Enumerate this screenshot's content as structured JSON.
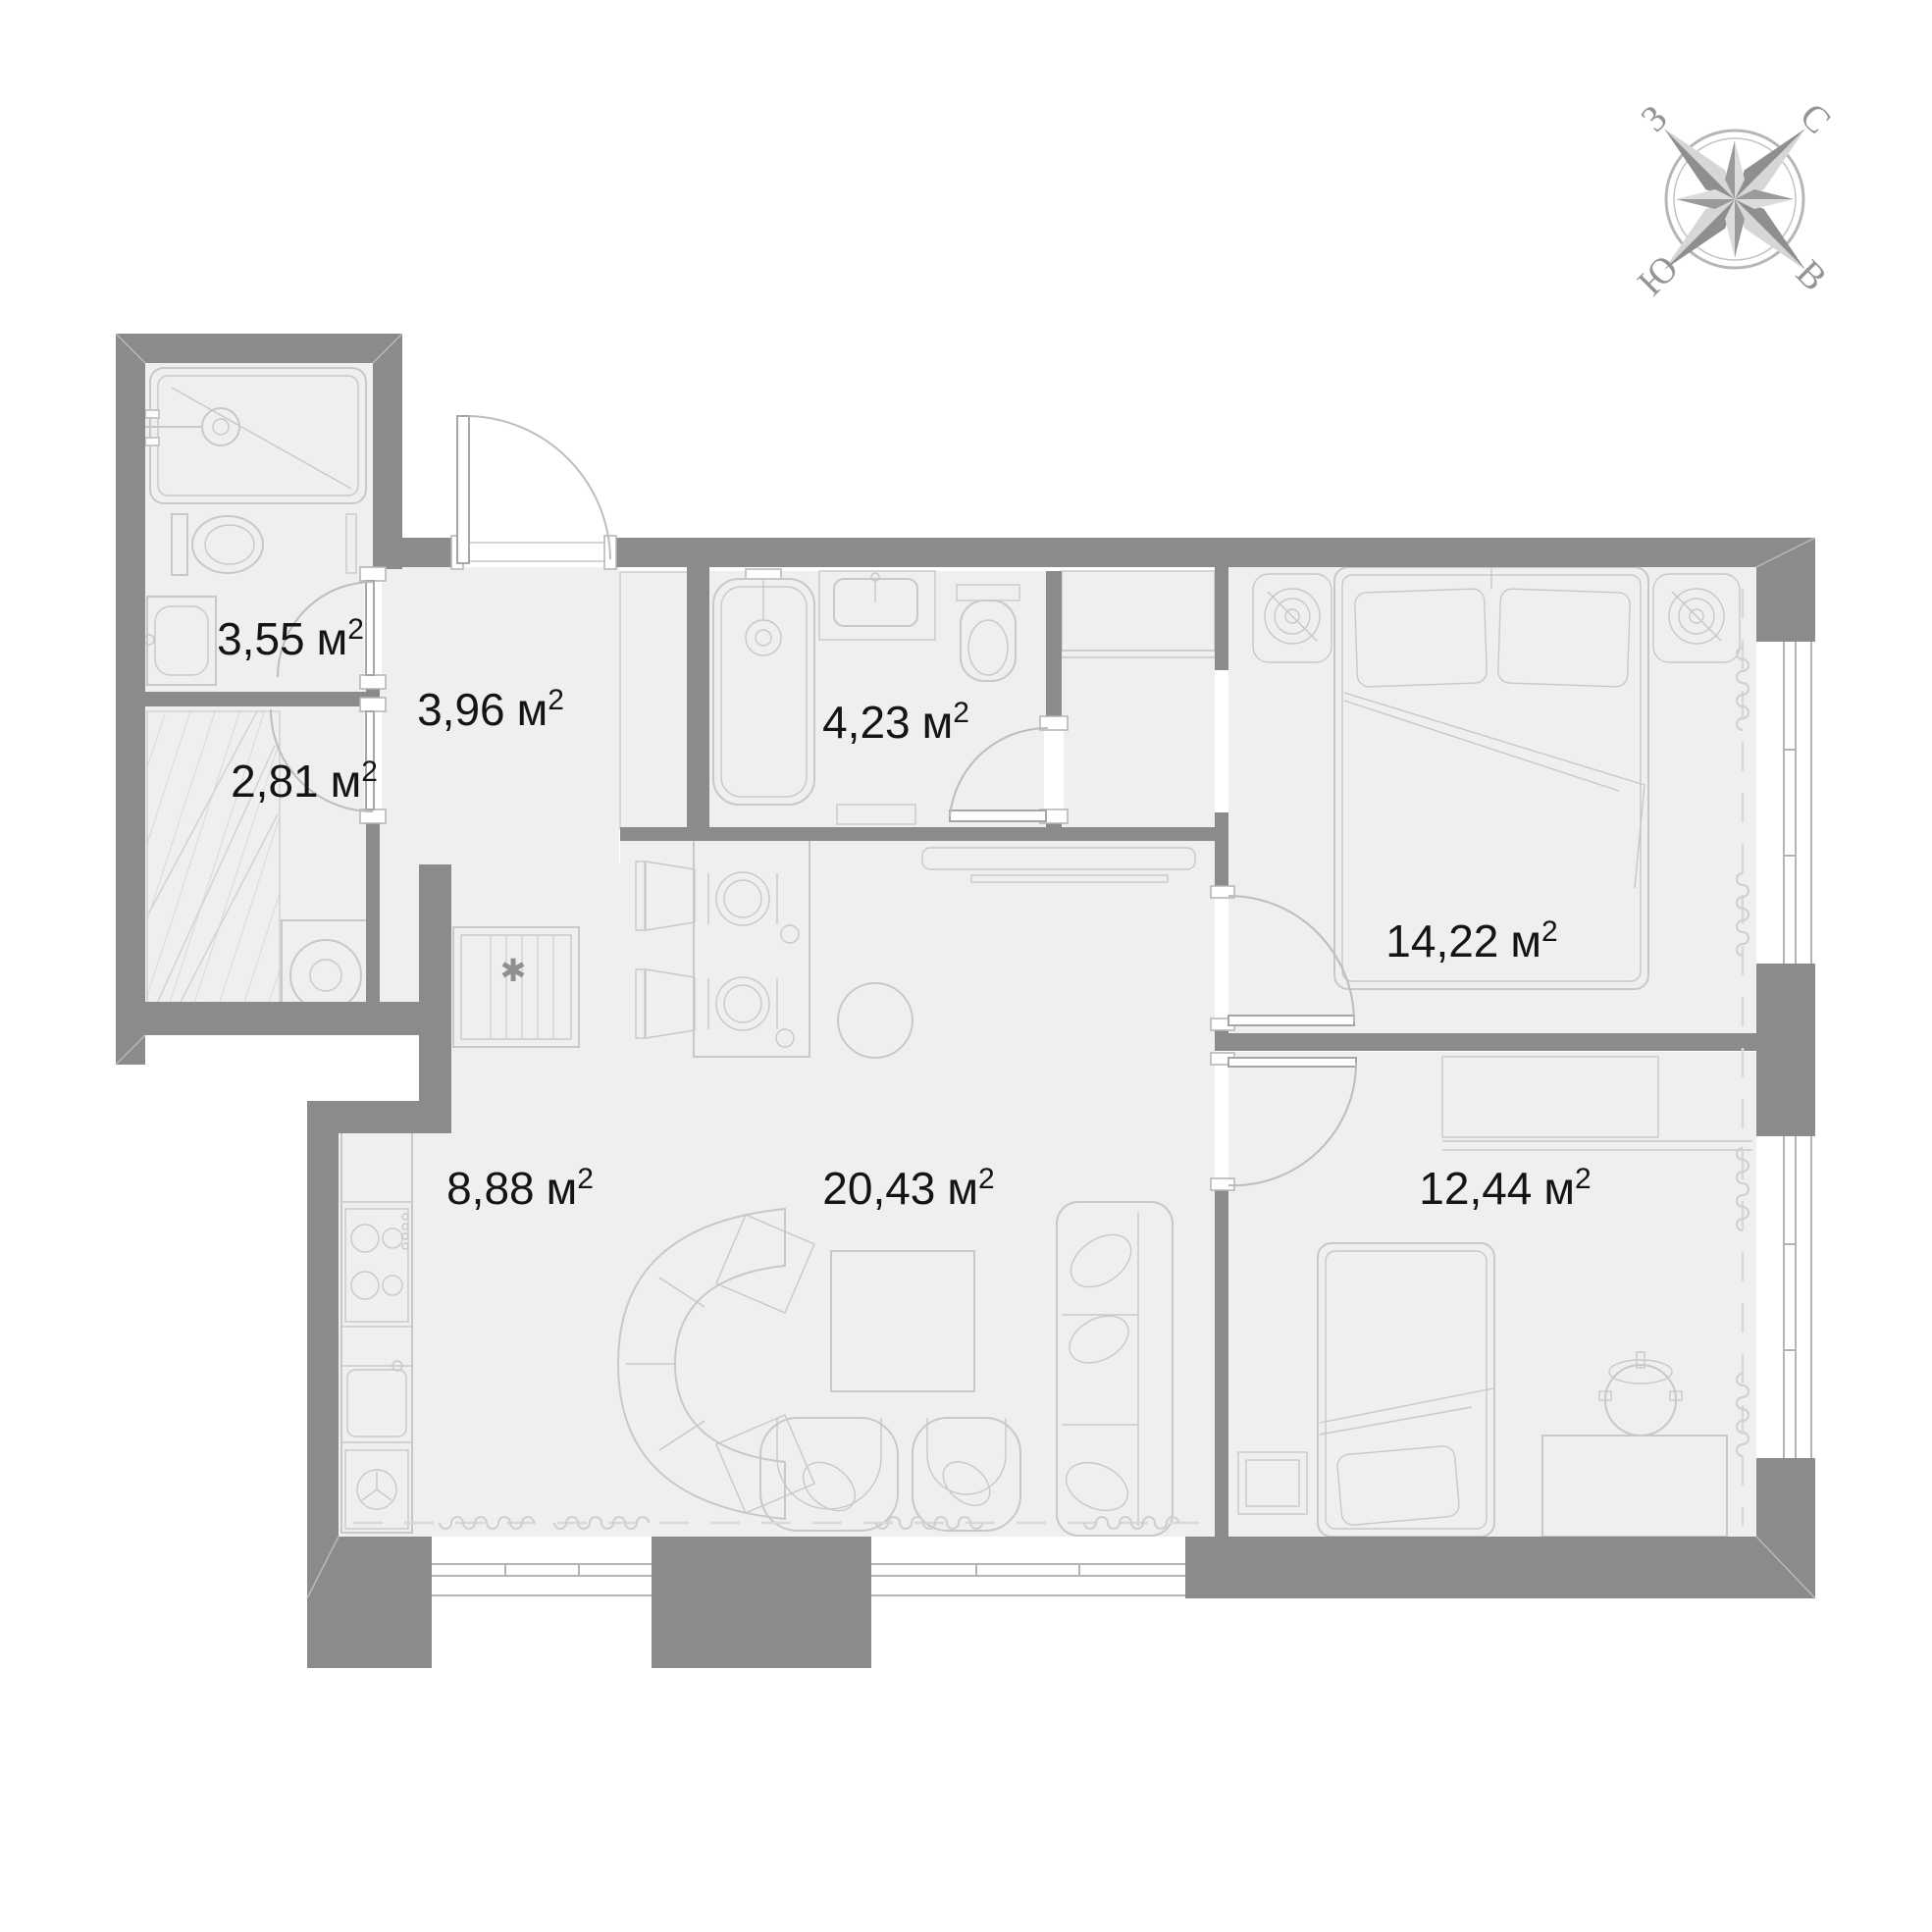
{
  "compass": {
    "north": "С",
    "east": "В",
    "south": "Ю",
    "west": "З"
  },
  "rooms": [
    {
      "name": "shower-room",
      "value": "3,55",
      "unit": "м",
      "sup": "2"
    },
    {
      "name": "storage-room",
      "value": "2,81",
      "unit": "м",
      "sup": "2"
    },
    {
      "name": "hallway",
      "value": "3,96",
      "unit": "м",
      "sup": "2"
    },
    {
      "name": "bathroom",
      "value": "4,23",
      "unit": "м",
      "sup": "2"
    },
    {
      "name": "bedroom",
      "value": "14,22",
      "unit": "м",
      "sup": "2"
    },
    {
      "name": "kitchen",
      "value": "8,88",
      "unit": "м",
      "sup": "2"
    },
    {
      "name": "living-room",
      "value": "20,43",
      "unit": "м",
      "sup": "2"
    },
    {
      "name": "bedroom-second",
      "value": "12,44",
      "unit": "м",
      "sup": "2"
    }
  ],
  "symbols": {
    "kitchen_marker": "✱"
  },
  "colors": {
    "wall": "#8b8b8b",
    "floor": "#efefef",
    "furniture_line": "#c8c8c8",
    "text": "#141414"
  }
}
